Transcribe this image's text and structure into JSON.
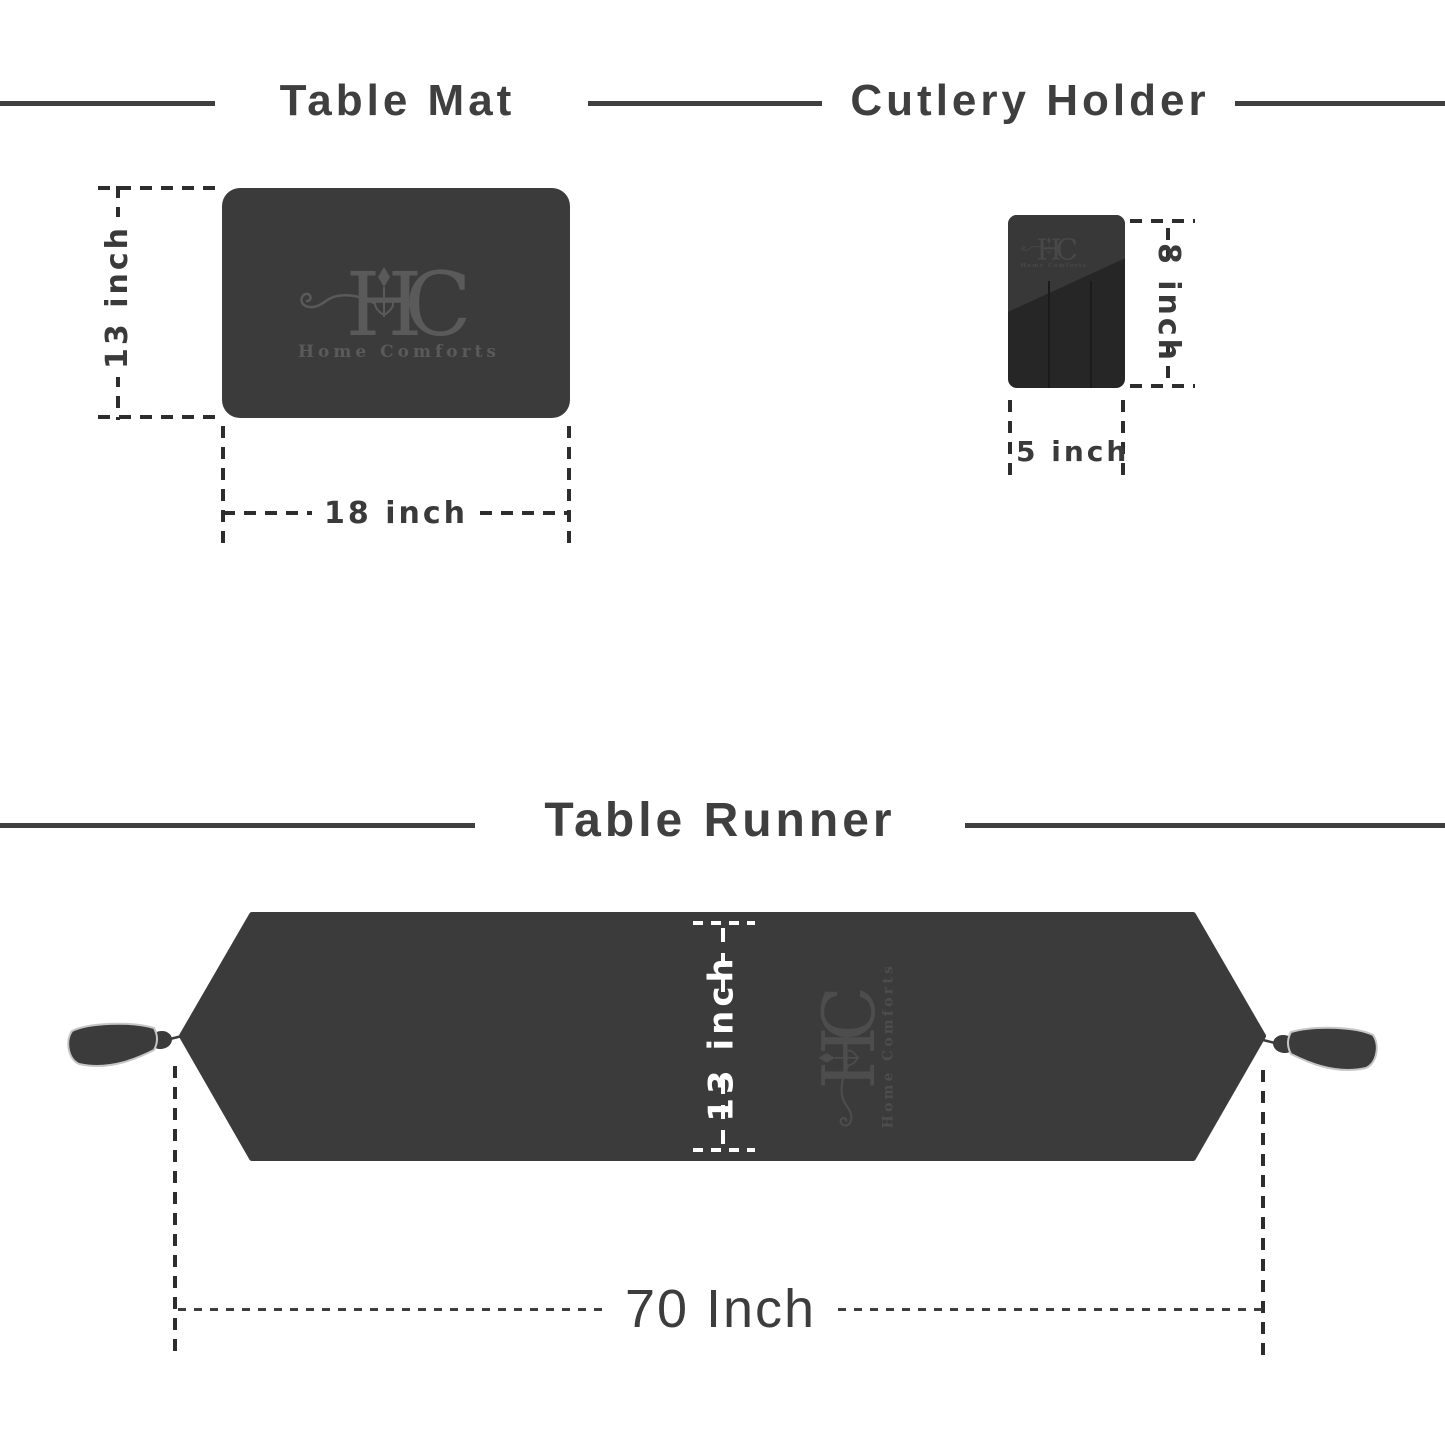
{
  "sections": {
    "table_mat": {
      "title": "Table Mat",
      "height_label": "13 inch",
      "width_label": "18 inch"
    },
    "cutlery_holder": {
      "title": "Cutlery Holder",
      "height_label": "8 inch",
      "width_label": "5 inch"
    },
    "table_runner": {
      "title": "Table Runner",
      "width_label": "13 inch",
      "length_label": "70 Inch"
    }
  },
  "brand": {
    "monogram_left": "H",
    "monogram_right": "C",
    "name": "Home Comforts"
  },
  "colors": {
    "fabric": "#3b3b3b",
    "holder_base": "#262626",
    "holder_flap": "#383838",
    "title_text": "#3f3f3f",
    "dimension_dash": "#2d2d2d",
    "runner_dimension": "#ffffff",
    "logo_on_mat": "#5a5a5a",
    "logo_on_holder": "#484848",
    "logo_on_runner": "#4d4d4d"
  }
}
